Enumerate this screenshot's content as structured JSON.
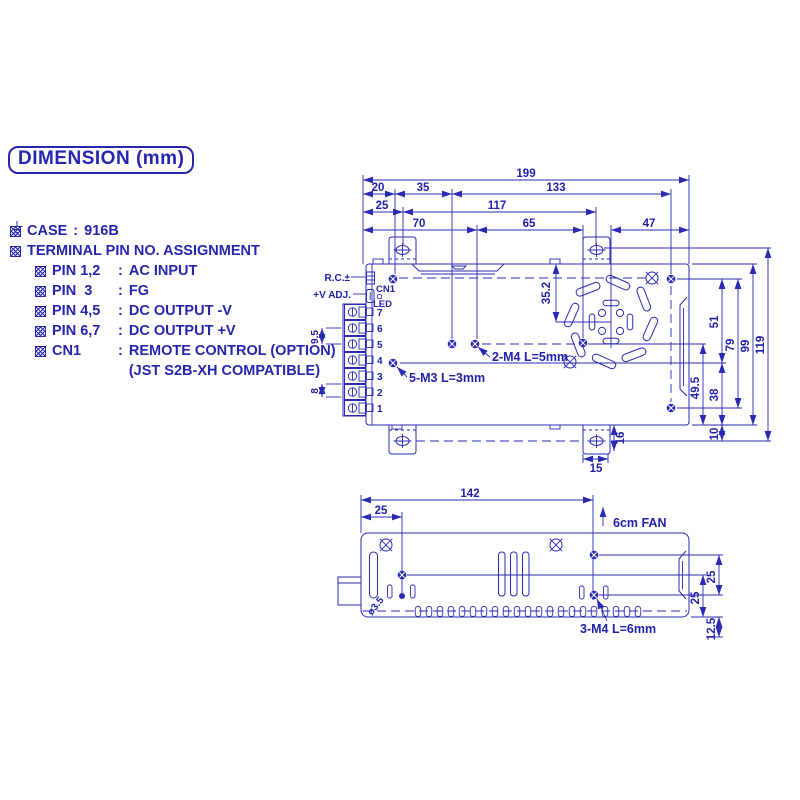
{
  "title": "DIMENSION (mm)",
  "colon": ":",
  "specs": {
    "case_label": "CASE",
    "case_value": "916B",
    "terminal_heading": "TERMINAL PIN NO. ASSIGNMENT",
    "pins": [
      {
        "label": "PIN 1,2",
        "value": "AC INPUT"
      },
      {
        "label": "PIN  3",
        "value": "FG"
      },
      {
        "label": "PIN 4,5",
        "value": "DC OUTPUT -V"
      },
      {
        "label": "PIN 6,7",
        "value": "DC OUTPUT +V"
      },
      {
        "label": "CN1",
        "value": "REMOTE CONTROL (OPTION)"
      }
    ],
    "cn1_note": "(JST S2B-XH COMPATIBLE)"
  },
  "top_view": {
    "d199": "199",
    "d20": "20",
    "d35": "35",
    "d133": "133",
    "d25": "25",
    "d117": "117",
    "d70": "70",
    "d65": "65",
    "d47": "47",
    "d352": "35.2",
    "d51": "51",
    "d79": "79",
    "d99": "99",
    "d119": "119",
    "d495": "49.5",
    "d38": "38",
    "d10": "10",
    "d16": "16",
    "d15": "15",
    "d95": "9.5",
    "d8": "8",
    "rc_label": "R.C.±",
    "vadj_label": "+V ADJ.",
    "cn1_label": "CN1",
    "led_label": "LED",
    "pins": [
      "7",
      "6",
      "5",
      "4",
      "3",
      "2",
      "1"
    ],
    "note_m3": "5-M3 L=3mm",
    "note_m4": "2-M4 L=5mm"
  },
  "side_view": {
    "d142": "142",
    "d25l": "25",
    "d25a": "25",
    "d25b": "25",
    "d125": "12.5",
    "fan_note": "6cm FAN",
    "hole_label": "ø3.5",
    "note_m4": "3-M4 L=6mm"
  },
  "colors": {
    "ink": "#2525ad",
    "background": "#ffffff"
  }
}
